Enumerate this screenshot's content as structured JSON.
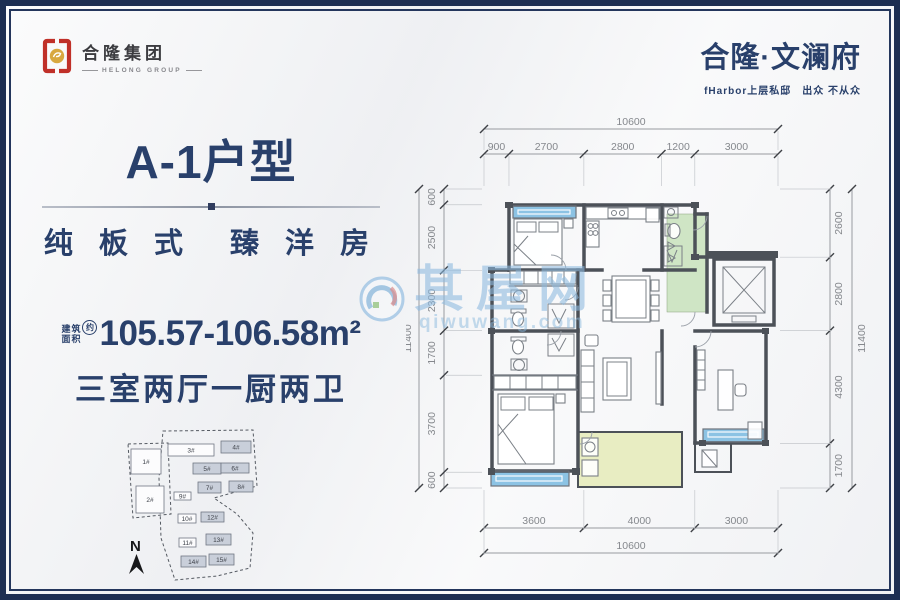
{
  "theme": {
    "navy": "#29406b",
    "frame_border": "#1d2e52",
    "logo_red": "#c03028",
    "logo_gold": "#d8a83f"
  },
  "header": {
    "logo_cn": "合隆集团",
    "logo_en": "HELONG GROUP",
    "project_name": "合隆·文澜府",
    "project_slogan": "fHarbor上层私邸　出众 不从众"
  },
  "unit_info": {
    "title": "A-1户型",
    "tagline": "纯 板 式　臻 洋 房",
    "area_prefix_top": "建筑",
    "area_prefix_bottom": "面积",
    "area_circle": "约",
    "area_value": "105.57-106.58m²",
    "rooms": "三室两厅一厨两卫"
  },
  "floorplan": {
    "dims": {
      "top_total": "10600",
      "top_segments": [
        900,
        2700,
        2800,
        1200,
        3000
      ],
      "bottom_total": "10600",
      "bottom_segments": [
        3600,
        4000,
        3000
      ],
      "left_total": "11400",
      "left_segments": [
        600,
        2500,
        2300,
        1700,
        3700,
        600
      ],
      "right_total": "11400",
      "right_segments": [
        2600,
        2800,
        4300,
        1700
      ]
    },
    "colors": {
      "wall": "#4c5158",
      "window_glass": "#8cc3e4",
      "foyer_floor": "#cfe5c5",
      "balcony_floor": "#e8edc2"
    }
  },
  "site_plan": {
    "north_label": "N",
    "buildings": [
      {
        "label": "1#",
        "x": 30,
        "y": 31,
        "w": 30,
        "h": 25,
        "type": "white"
      },
      {
        "label": "2#",
        "x": 35,
        "y": 68,
        "w": 28,
        "h": 27,
        "type": "white"
      },
      {
        "label": "3#",
        "x": 67,
        "y": 26,
        "w": 46,
        "h": 12,
        "type": "white"
      },
      {
        "label": "4#",
        "x": 120,
        "y": 23,
        "w": 30,
        "h": 12,
        "type": "gray"
      },
      {
        "label": "5#",
        "x": 92,
        "y": 45,
        "w": 28,
        "h": 11,
        "type": "gray"
      },
      {
        "label": "6#",
        "x": 120,
        "y": 45,
        "w": 28,
        "h": 10,
        "type": "gray"
      },
      {
        "label": "7#",
        "x": 97,
        "y": 64,
        "w": 23,
        "h": 11,
        "type": "gray"
      },
      {
        "label": "8#",
        "x": 128,
        "y": 63,
        "w": 24,
        "h": 11,
        "type": "gray"
      },
      {
        "label": "9#",
        "x": 73,
        "y": 74,
        "w": 17,
        "h": 8,
        "type": "white"
      },
      {
        "label": "10#",
        "x": 77,
        "y": 96,
        "w": 18,
        "h": 9,
        "type": "white"
      },
      {
        "label": "12#",
        "x": 100,
        "y": 94,
        "w": 23,
        "h": 10,
        "type": "gray"
      },
      {
        "label": "11#",
        "x": 78,
        "y": 120,
        "w": 17,
        "h": 9,
        "type": "white"
      },
      {
        "label": "13#",
        "x": 105,
        "y": 116,
        "w": 25,
        "h": 11,
        "type": "gray"
      },
      {
        "label": "14#",
        "x": 80,
        "y": 138,
        "w": 25,
        "h": 11,
        "type": "gray"
      },
      {
        "label": "15#",
        "x": 108,
        "y": 136,
        "w": 25,
        "h": 11,
        "type": "gray"
      }
    ]
  },
  "watermark": {
    "cn": "其屋网",
    "en": "qiwuwang.com"
  }
}
